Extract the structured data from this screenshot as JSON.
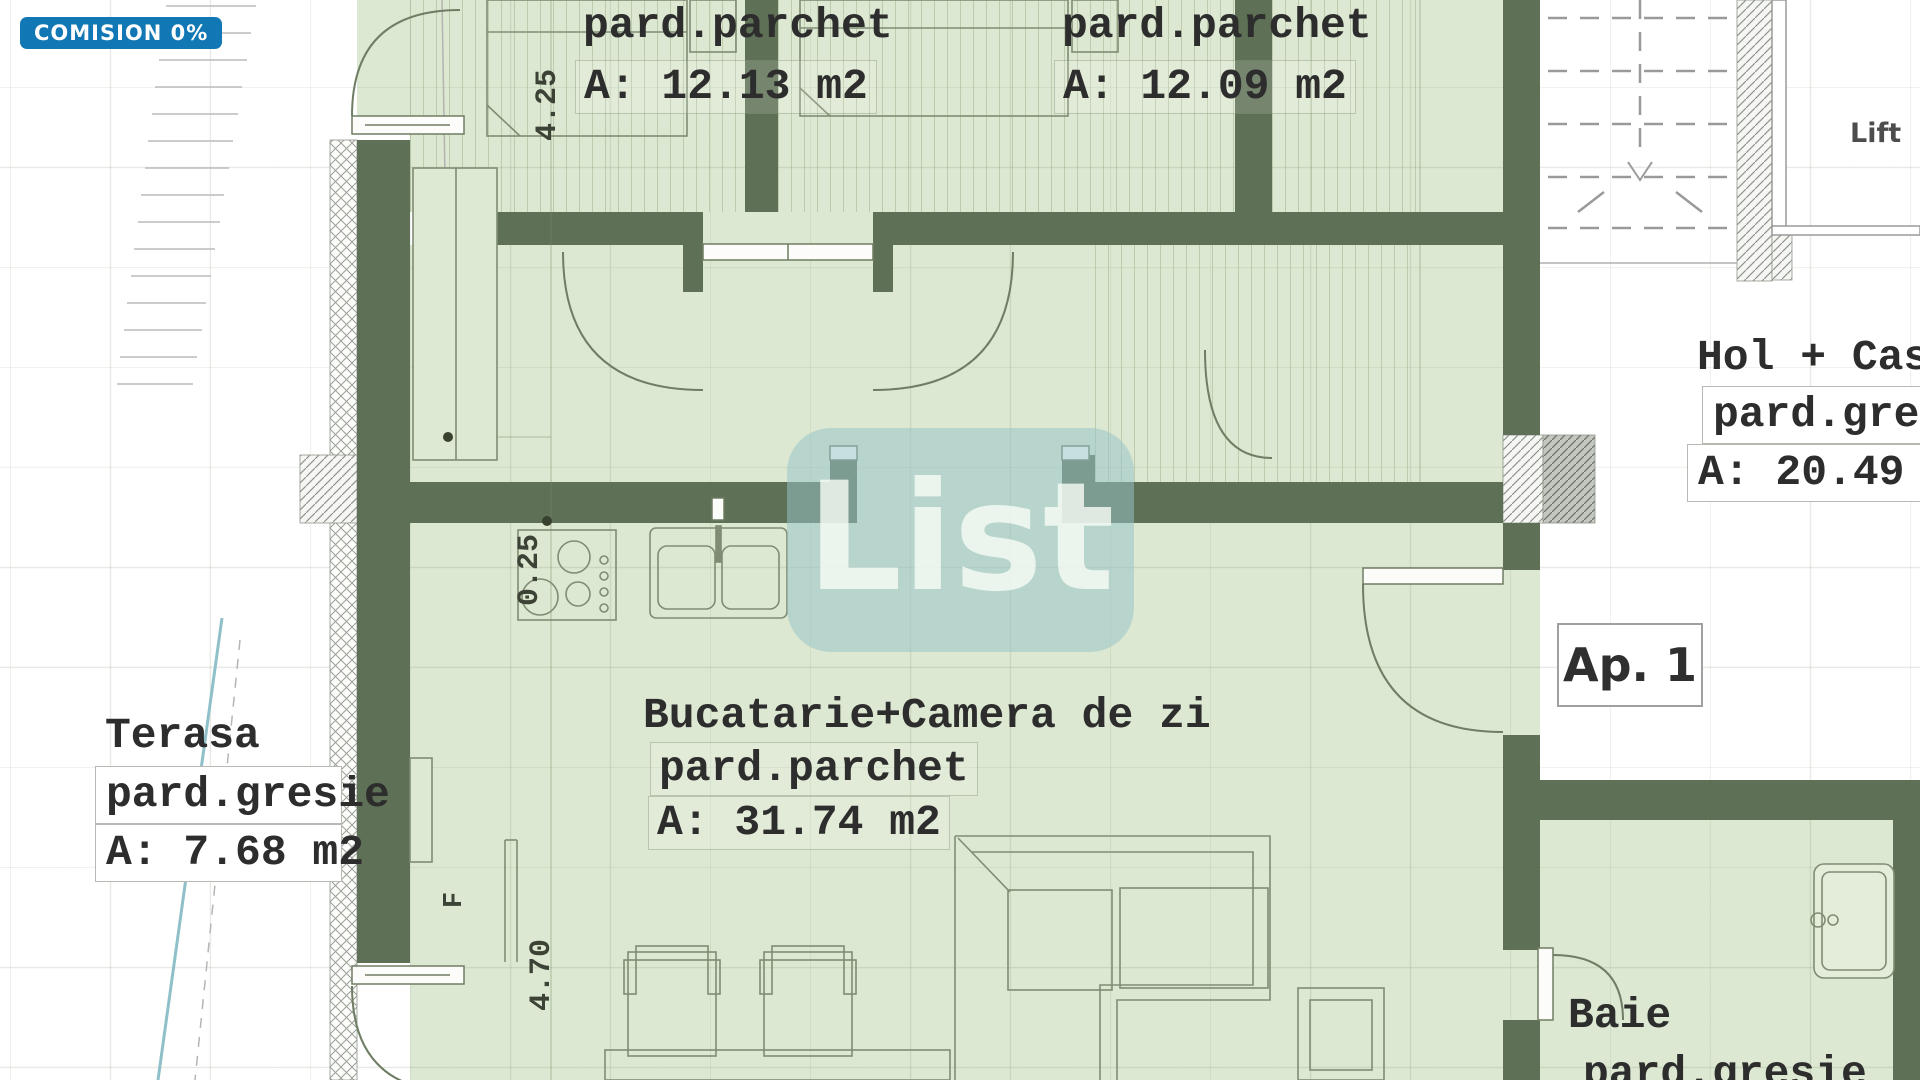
{
  "badge": {
    "label": "COMISION 0%"
  },
  "watermark": {
    "label": "List"
  },
  "plan": {
    "bedroom1": {
      "l1": "pard.parchet",
      "l2": "A: 12.13 m2"
    },
    "bedroom2": {
      "l1": "pard.parchet",
      "l2": "A: 12.09 m2"
    },
    "kitchen": {
      "l1": "Bucatarie+Camera de zi",
      "l2": "pard.parchet",
      "l3": "A: 31.74 m2"
    },
    "terasa": {
      "l1": "Terasa",
      "l2": "pard.gresie",
      "l3": "A: 7.68 m2"
    },
    "hall": {
      "l1": "Hol + Cas",
      "l2": "pard.gre",
      "l3": "A: 20.49"
    },
    "bath": {
      "l1": "Baie",
      "l2": "pard.gresie"
    },
    "apartment": {
      "label": "Ap. 1"
    },
    "lift": {
      "label": "Lift"
    },
    "dims": {
      "top": "4.25",
      "wall": "0.25",
      "bottom": "4.70",
      "f": "F"
    }
  },
  "colors": {
    "wall": "#5e7055",
    "room": "#dce8d1",
    "badge_bg": "#1178b5",
    "watermark_bg": "#97c4c9"
  }
}
